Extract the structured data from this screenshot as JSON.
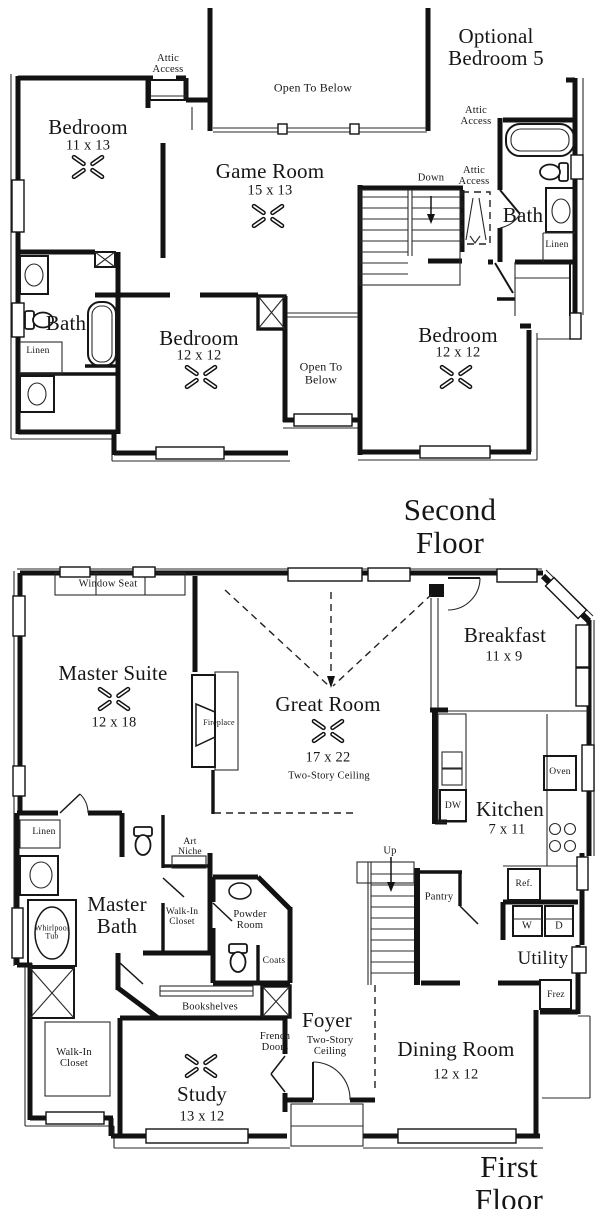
{
  "second_floor": {
    "title": "Second Floor",
    "optional_room": "Optional\nBedroom 5",
    "attic_access": "Attic\nAccess",
    "open_to_below": "Open To Below",
    "open_to_below_2": "Open To\nBelow",
    "down": "Down",
    "bath": "Bath",
    "bath2": "Bath",
    "linen": "Linen",
    "linen2": "Linen",
    "bedroom1": {
      "name": "Bedroom",
      "dims": "11 x 13"
    },
    "game_room": {
      "name": "Game Room",
      "dims": "15 x 13"
    },
    "bedroom2": {
      "name": "Bedroom",
      "dims": "12 x 12"
    },
    "bedroom3": {
      "name": "Bedroom",
      "dims": "12 x 12"
    }
  },
  "first_floor": {
    "title": "First Floor",
    "window_seat": "Window Seat",
    "master_suite": {
      "name": "Master Suite",
      "dims": "12 x 18"
    },
    "fireplace": "Fireplace",
    "great_room": {
      "name": "Great Room",
      "dims": "17 x 22",
      "note": "Two-Story Ceiling"
    },
    "breakfast": {
      "name": "Breakfast",
      "dims": "11 x 9"
    },
    "kitchen": {
      "name": "Kitchen",
      "dims": "7 x 11"
    },
    "oven": "Oven",
    "dw": "DW",
    "ref": "Ref.",
    "washer": "W",
    "dryer": "D",
    "freezer": "Frez",
    "utility": "Utility",
    "pantry": "Pantry",
    "up": "Up",
    "linen": "Linen",
    "art_niche": "Art\nNiche",
    "master_bath": "Master\nBath",
    "whirlpool_tub": "Whirlpool\nTub",
    "walk_in_closet": "Walk-In\nCloset",
    "walk_in_closet_2": "Walk-In\nCloset",
    "powder_room": "Powder\nRoom",
    "coats": "Coats",
    "bookshelves": "Bookshelves",
    "french_doors": "French\nDoors",
    "study": {
      "name": "Study",
      "dims": "13 x 12"
    },
    "foyer": {
      "name": "Foyer",
      "note": "Two-Story\nCeiling"
    },
    "dining_room": {
      "name": "Dining Room",
      "dims": "12 x 12"
    }
  }
}
